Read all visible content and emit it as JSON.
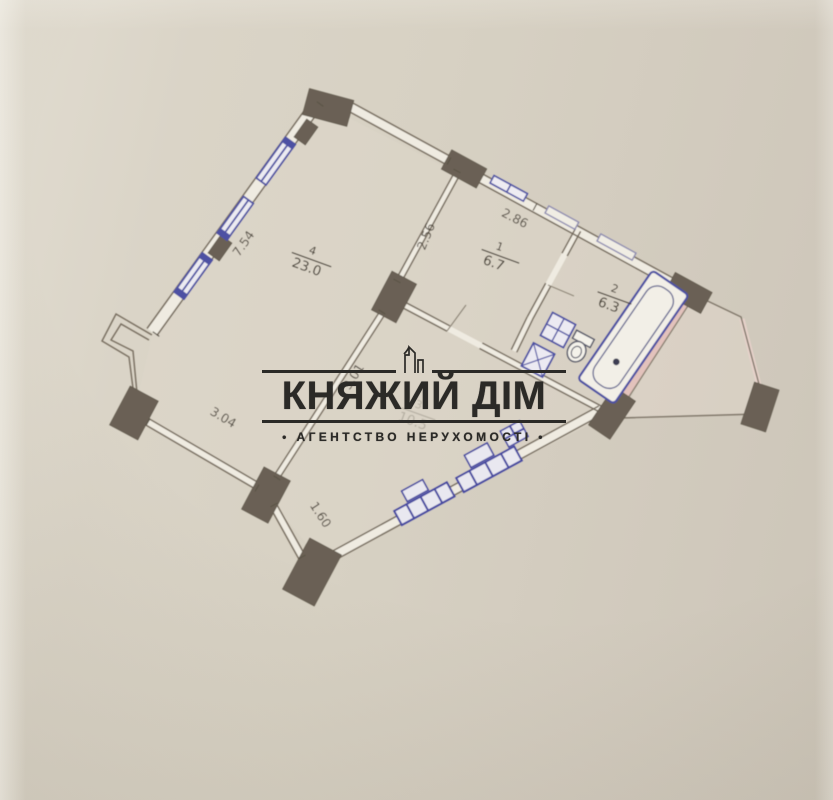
{
  "watermark": {
    "title": "КНЯЖИЙ ДІМ",
    "subtitle": "• АГЕНТСТВО НЕРУХОМОСТІ •",
    "logo_icon": "highrise-building-icon",
    "text_color": "#2b2a27"
  },
  "plan": {
    "rooms": [
      {
        "number": "1",
        "area": "6.7"
      },
      {
        "number": "2",
        "area": "6.3"
      },
      {
        "number": "3",
        "area": "10.5"
      },
      {
        "number": "4",
        "area": "23.0"
      }
    ],
    "dimensions": {
      "window_wall": "7.54",
      "hall_left_wall": "2.56",
      "hall_top_wall": "2.86",
      "lower_left_wall": "3.04",
      "diagonal_inner_wall": "3.01",
      "short_lower_wall": "1.60"
    },
    "colors": {
      "paper": "#d7d1c3",
      "wall_line": "#776d5f",
      "pier_fill": "#6a6154",
      "window_frame": "#4e51a3",
      "balcony_wall": "#e3c2bc",
      "label_text": "#4a4339"
    }
  }
}
